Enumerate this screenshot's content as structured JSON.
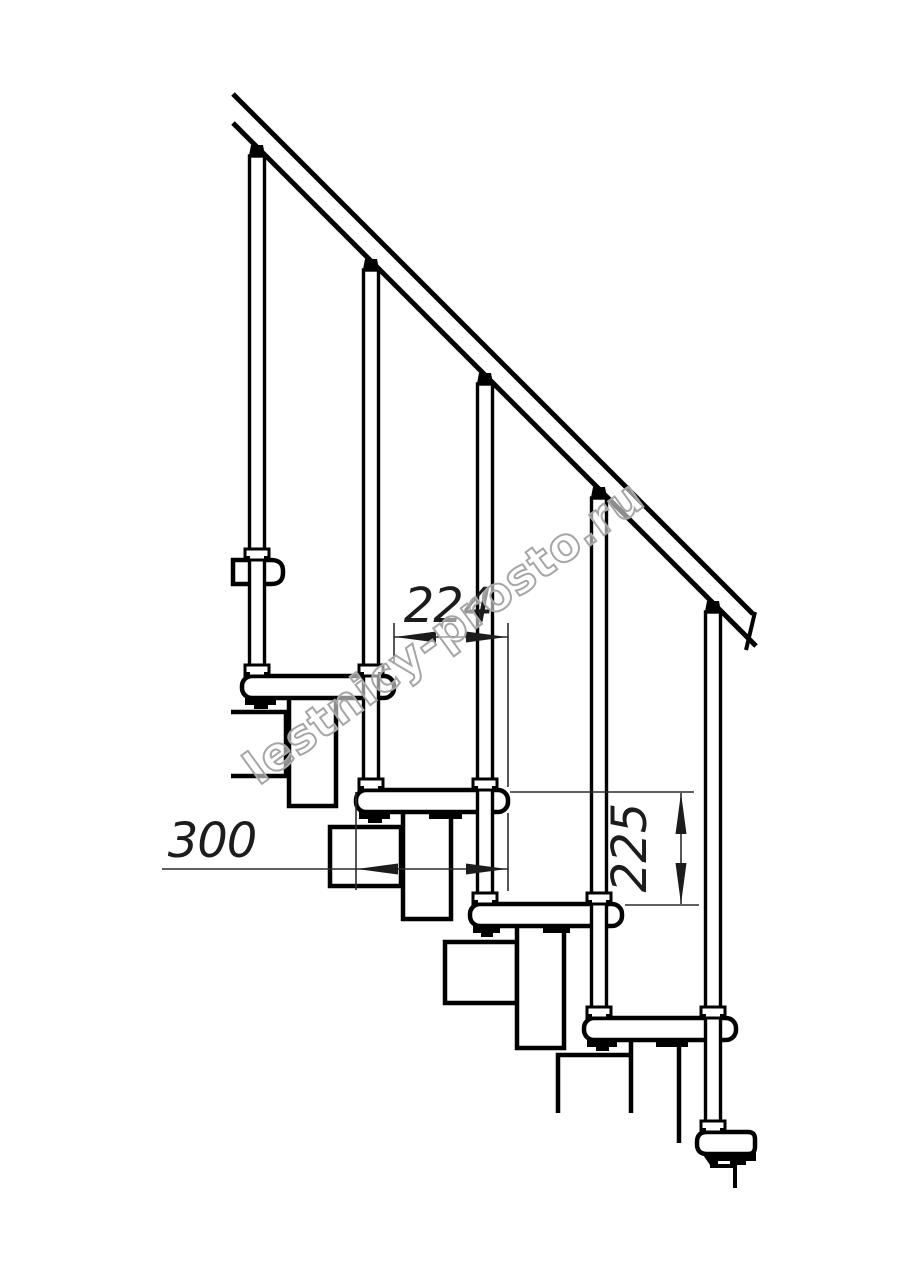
{
  "watermark": {
    "text": "lestnicy-prosto.ru",
    "outline_color": "#a6a6a6"
  },
  "dimensions": {
    "going": {
      "value": "224"
    },
    "tread_depth": {
      "value": "300"
    },
    "rise": {
      "value": "225"
    }
  },
  "drawing_colors": {
    "line": "#000000",
    "dimension_line": "#2b2b2b",
    "background": "#ffffff"
  }
}
